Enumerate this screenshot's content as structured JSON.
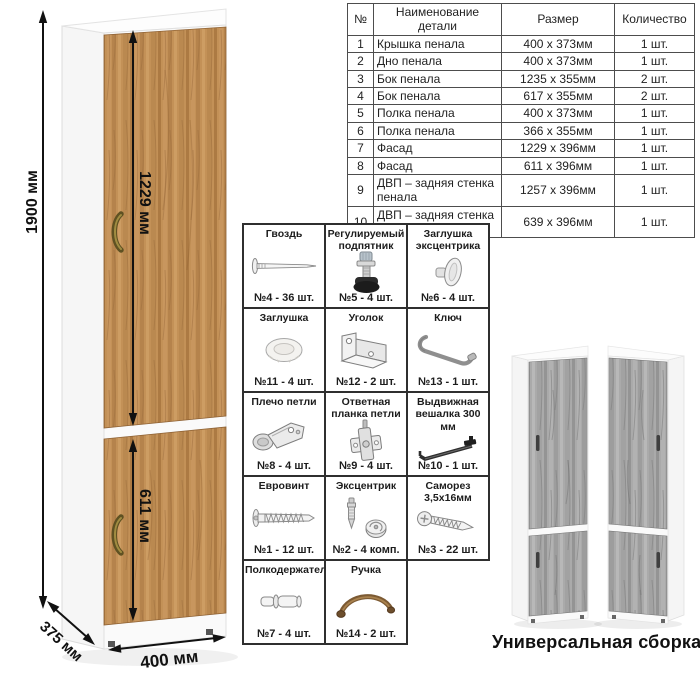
{
  "page": {
    "caption": "Универсальная сборка."
  },
  "dimensions": {
    "height_total": "1900 мм",
    "door_top": "1229 мм",
    "door_bottom": "611 мм",
    "depth": "375 мм",
    "width": "400 мм"
  },
  "parts_table": {
    "headers": {
      "num": "№",
      "name": "Наименование детали",
      "size": "Размер",
      "qty": "Количество"
    },
    "rows": [
      {
        "num": "1",
        "name": "Крышка пенала",
        "size": "400 х 373мм",
        "qty": "1 шт."
      },
      {
        "num": "2",
        "name": "Дно пенала",
        "size": "400 х 373мм",
        "qty": "1 шт."
      },
      {
        "num": "3",
        "name": "Бок пенала",
        "size": "1235 х 355мм",
        "qty": "2 шт."
      },
      {
        "num": "4",
        "name": "Бок пенала",
        "size": "617 х 355мм",
        "qty": "2 шт."
      },
      {
        "num": "5",
        "name": "Полка пенала",
        "size": "400 х 373мм",
        "qty": "1 шт."
      },
      {
        "num": "6",
        "name": "Полка пенала",
        "size": "366 х 355мм",
        "qty": "1 шт."
      },
      {
        "num": "7",
        "name": "Фасад",
        "size": "1229 х 396мм",
        "qty": "1 шт."
      },
      {
        "num": "8",
        "name": "Фасад",
        "size": "611 х 396мм",
        "qty": "1 шт."
      },
      {
        "num": "9",
        "name": "ДВП – задняя стенка пенала",
        "size": "1257 х 396мм",
        "qty": "1 шт."
      },
      {
        "num": "10",
        "name": "ДВП – задняя стенка пенала",
        "size": "639 х 396мм",
        "qty": "1 шт."
      }
    ]
  },
  "hardware": {
    "items": [
      {
        "name": "Гвоздь",
        "count": "№4 - 36 шт.",
        "icon": "nail-icon"
      },
      {
        "name": "Регулируемый подпятник",
        "count": "№5 - 4 шт.",
        "icon": "adjustable-foot-icon"
      },
      {
        "name": "Заглушка эксцентрика",
        "count": "№6 - 4 шт.",
        "icon": "cam-cap-icon"
      },
      {
        "name": "Заглушка",
        "count": "№11 - 4 шт.",
        "icon": "cap-icon"
      },
      {
        "name": "Уголок",
        "count": "№12 - 2 шт.",
        "icon": "corner-bracket-icon"
      },
      {
        "name": "Ключ",
        "count": "№13 - 1 шт.",
        "icon": "key-icon"
      },
      {
        "name": "Плечо петли",
        "count": "№8 - 4 шт.",
        "icon": "hinge-arm-icon"
      },
      {
        "name": "Ответная планка петли",
        "count": "№9 - 4 шт.",
        "icon": "hinge-plate-icon"
      },
      {
        "name": "Выдвижная вешалка 300 мм",
        "count": "№10 - 1 шт.",
        "icon": "pullout-hanger-icon"
      },
      {
        "name": "Евровинт",
        "count": "№1 - 12 шт.",
        "icon": "confirmat-screw-icon"
      },
      {
        "name": "Эксцентрик",
        "count": "№2 - 4 комп.",
        "icon": "cam-lock-icon"
      },
      {
        "name": "Саморез 3,5х16мм",
        "count": "№3 - 22 шт.",
        "icon": "self-tapping-screw-icon"
      },
      {
        "name": "Полкодержатель",
        "count": "№7 - 4 шт.",
        "icon": "shelf-pin-icon"
      },
      {
        "name": "Ручка",
        "count": "№14 - 2 шт.",
        "icon": "handle-icon"
      }
    ]
  },
  "colors": {
    "wood": "#c39157",
    "wood_dark": "#ac7a43",
    "gray_wood": "#aaaaaa",
    "handle_bronze": "#5f5122",
    "dimension_line": "#111111",
    "grid_border": "#2f2f2f"
  }
}
